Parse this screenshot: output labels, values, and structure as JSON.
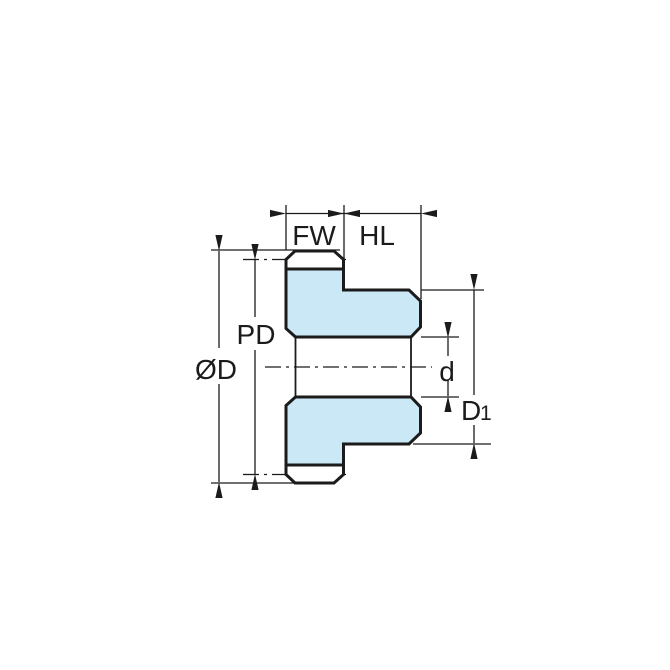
{
  "diagram": {
    "labels": {
      "face_width": "FW",
      "hub_length": "HL",
      "pitch_diameter": "PD",
      "outside_diameter": "ØD",
      "bore_diameter": "d",
      "hub_diameter_main": "D",
      "hub_diameter_sub": "1"
    },
    "colors": {
      "part_fill": "#CBE8F7",
      "line": "#1B1B1B",
      "background": "#FFFFFF"
    }
  }
}
